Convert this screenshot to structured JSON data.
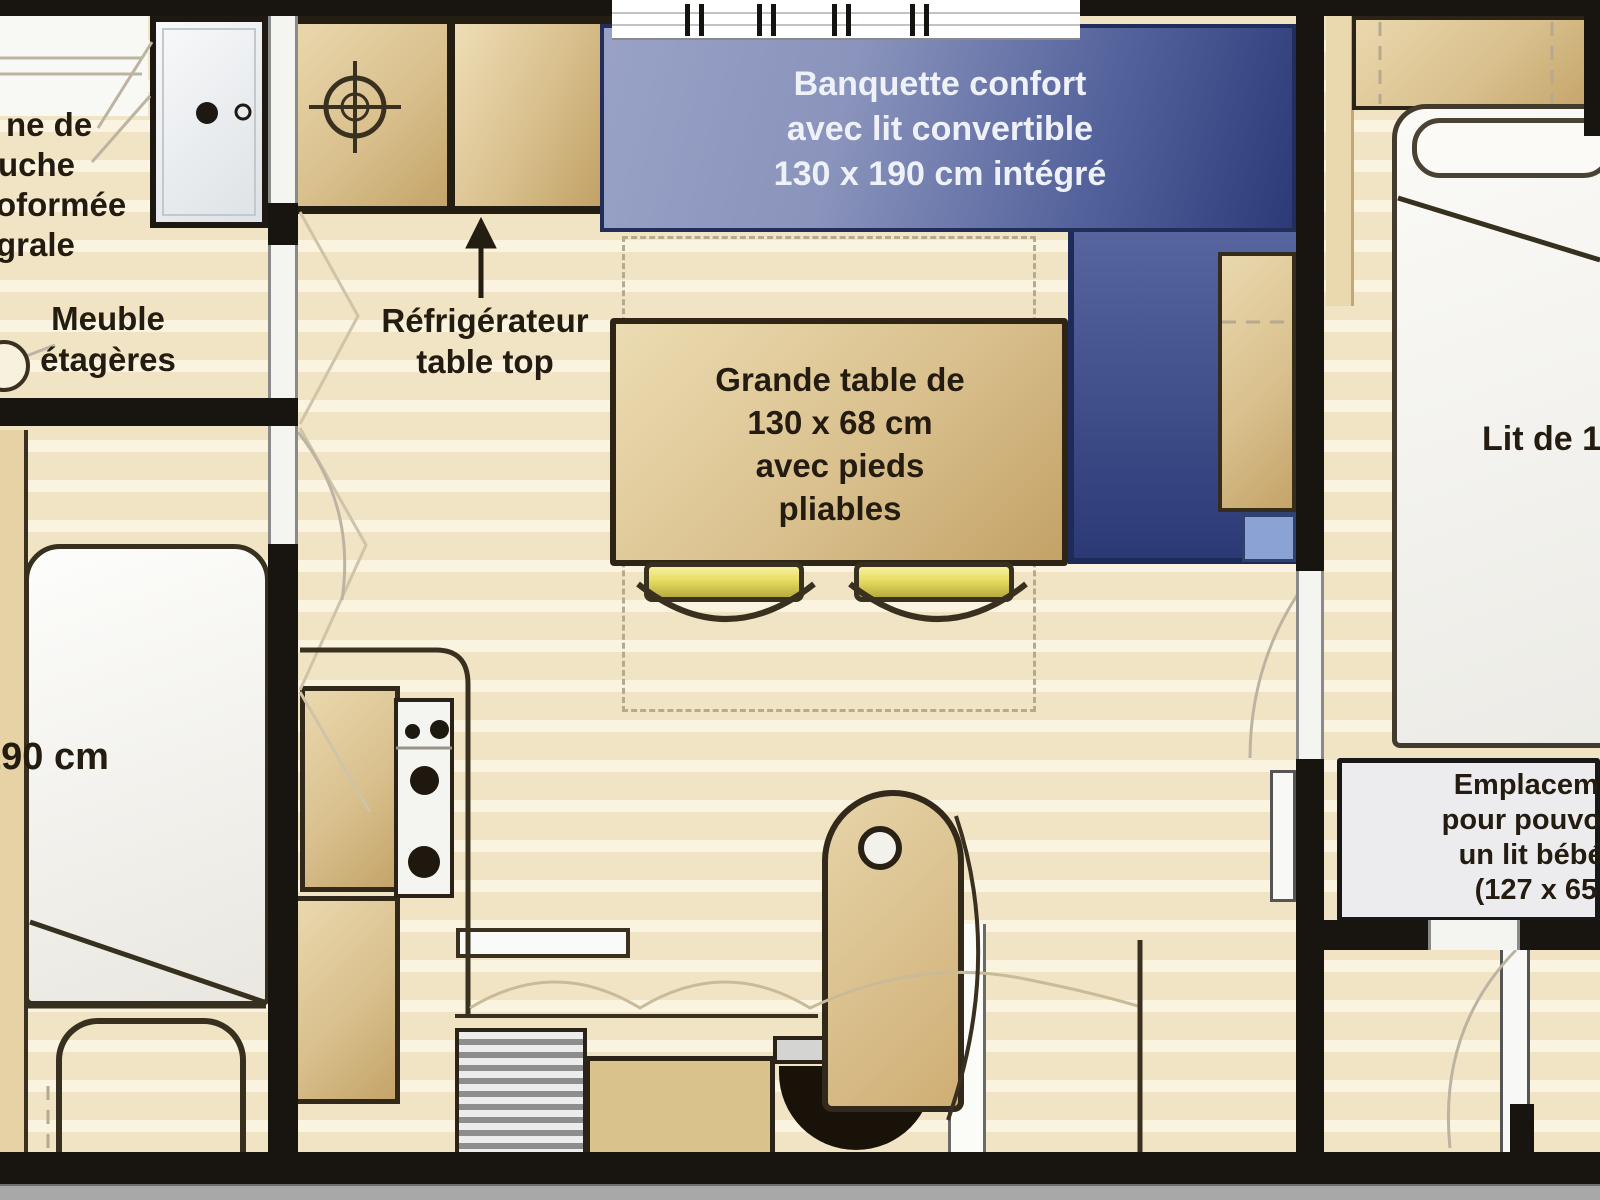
{
  "floorplan": {
    "type": "mobile-home floor plan",
    "labels": {
      "shower": {
        "lines": [
          "ne de",
          "uche",
          "oformée",
          "grale"
        ]
      },
      "meuble": {
        "lines": [
          "Meuble",
          "étagères"
        ]
      },
      "fridge": {
        "lines": [
          "Réfrigérateur",
          "table top"
        ]
      },
      "banquette": {
        "lines": [
          "Banquette confort",
          "avec lit convertible",
          "130 x 190 cm intégré"
        ]
      },
      "table": {
        "lines": [
          "Grande table de",
          "130 x 68 cm",
          "avec pieds",
          "pliables"
        ]
      },
      "bed_left": {
        "size": "190 cm"
      },
      "bed_right": {
        "label": "Lit de 1"
      },
      "baby_space": {
        "lines": [
          "Emplacement",
          "pour pouvoir in",
          "un lit bébé pl",
          "(127 x 65 c"
        ]
      }
    },
    "colors": {
      "floor": "#f4e9cf",
      "wood": "#d9c08d",
      "wall": "#181410",
      "banquette_blue_light": "#99a2c6",
      "banquette_blue_dark": "#2c3a78",
      "chair_yellow": "#e7dc62",
      "banquette_text": "#eef1f8",
      "label_text": "#241c10"
    }
  }
}
